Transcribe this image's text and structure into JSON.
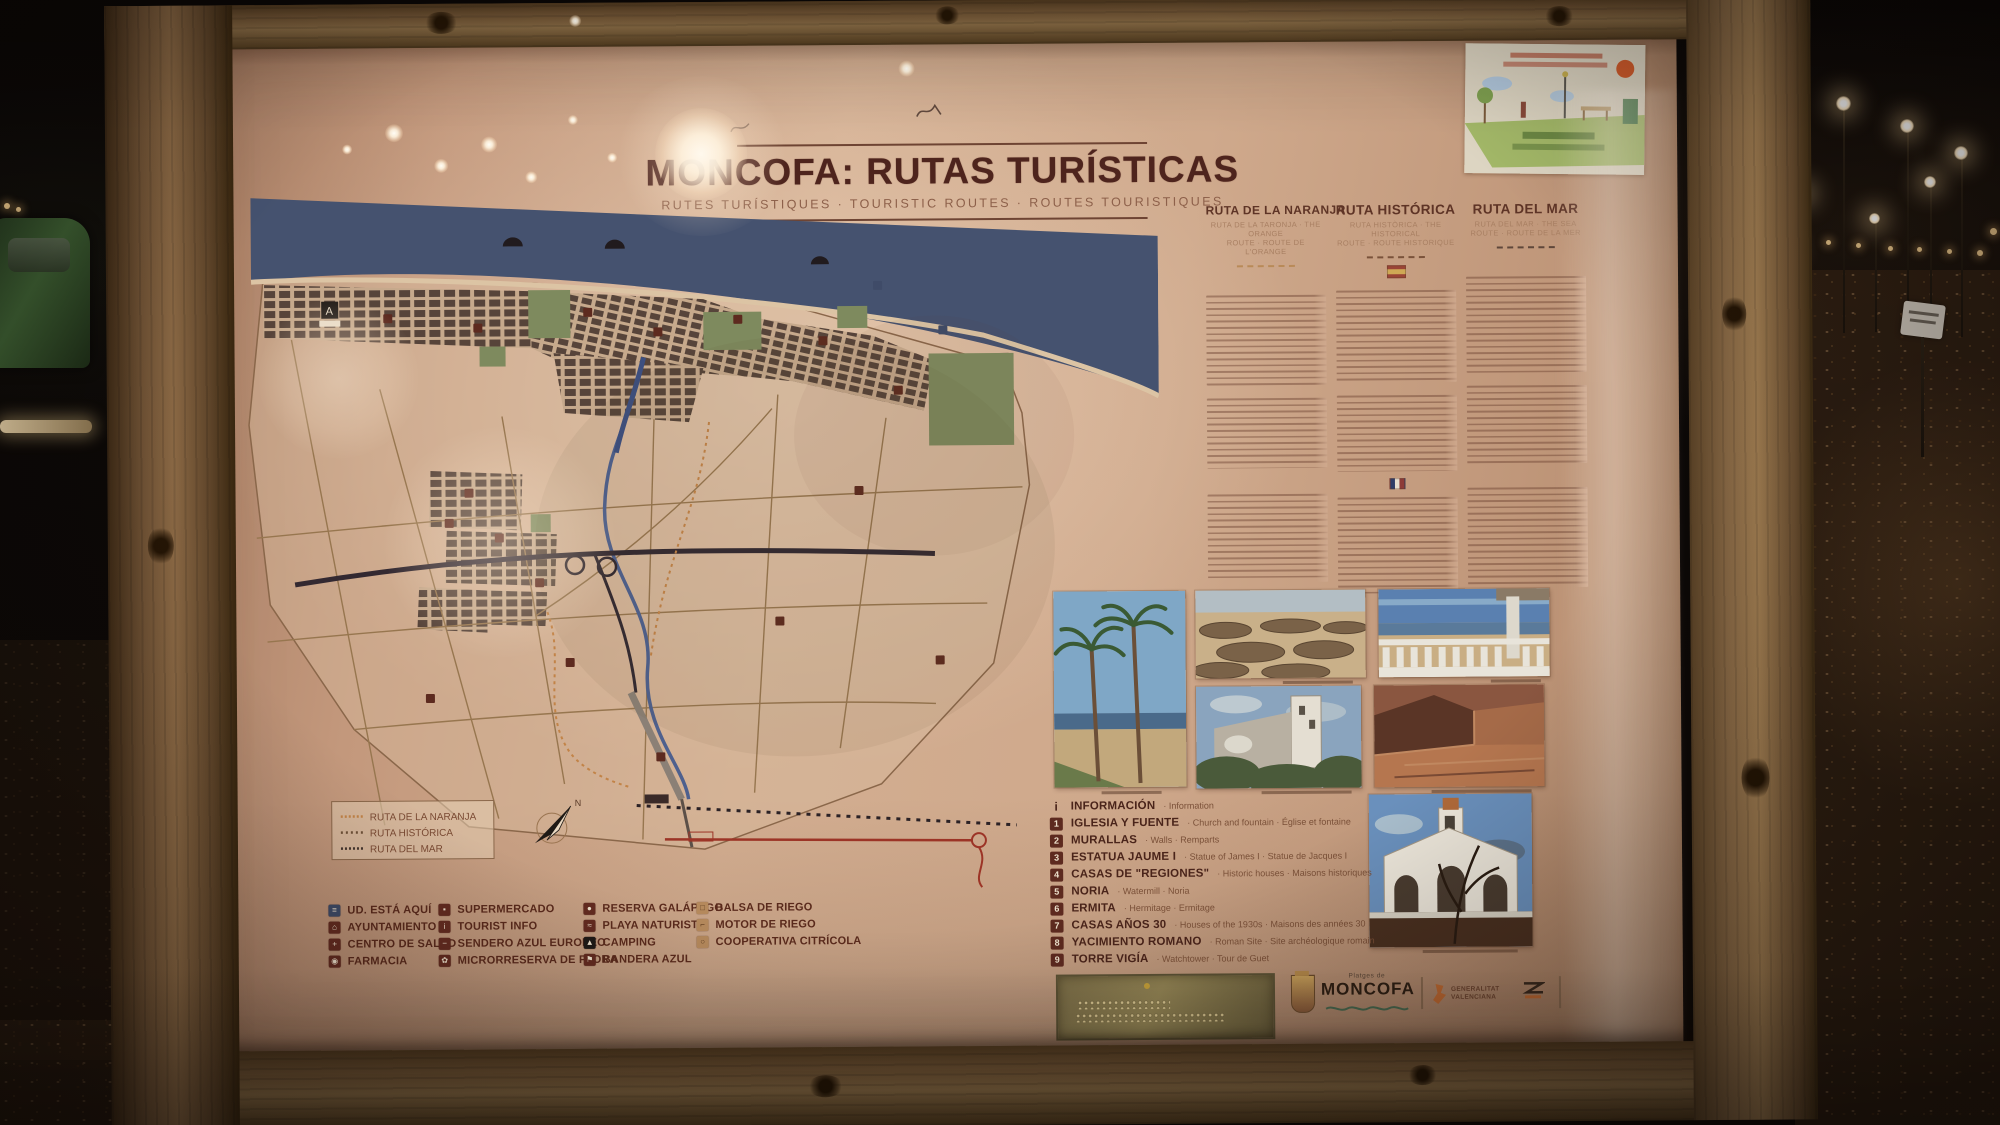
{
  "sign": {
    "title": "MONCOFA: RUTAS TURÍSTICAS",
    "subtitle": "RUTES TURÍSTIQUES · TOURISTIC ROUTES · ROUTES TOURISTIQUES",
    "routes": [
      {
        "name": "RUTA DE LA NARANJA",
        "sub1": "RUTA DE LA TARONJA · THE ORANGE",
        "sub2": "ROUTE · ROUTE DE L'ORANGE"
      },
      {
        "name": "RUTA HISTÓRICA",
        "sub1": "RUTA HISTÒRICA · THE HISTORICAL",
        "sub2": "ROUTE · ROUTE HISTORIQUE"
      },
      {
        "name": "RUTA DEL MAR",
        "sub1": "RUTA DEL MAR · THE SEA",
        "sub2": "ROUTE · ROUTE DE LA MER"
      }
    ],
    "map_legend": [
      "RUTA DE LA NARANJA",
      "RUTA HISTÓRICA",
      "RUTA DEL MAR"
    ],
    "compass_n": "N",
    "legend": {
      "columns": [
        {
          "items": [
            {
              "glyph": "≡",
              "icon": "you-are-here-icon",
              "label": "UD. ESTÁ AQUÍ"
            },
            {
              "glyph": "⌂",
              "icon": "town-hall-icon",
              "label": "AYUNTAMIENTO"
            },
            {
              "glyph": "+",
              "icon": "health-centre-icon",
              "label": "CENTRO DE SALUD"
            },
            {
              "glyph": "◉",
              "icon": "pharmacy-icon",
              "label": "FARMACIA"
            }
          ]
        },
        {
          "items": [
            {
              "glyph": "▪",
              "icon": "supermarket-icon",
              "label": "SUPERMERCADO"
            },
            {
              "glyph": "i",
              "icon": "tourist-info-icon",
              "label": "TOURIST INFO"
            },
            {
              "glyph": "−",
              "icon": "blue-trail-icon",
              "label": "SENDERO AZUL EUROPEO"
            },
            {
              "glyph": "✿",
              "icon": "flora-reserve-icon",
              "label": "MICRORRESERVA DE FLORA"
            }
          ]
        },
        {
          "items": [
            {
              "glyph": "●",
              "icon": "turtle-reserve-icon",
              "label": "RESERVA GALÁPAGO"
            },
            {
              "glyph": "≈",
              "icon": "naturist-beach-icon",
              "label": "PLAYA NATURISTA"
            },
            {
              "glyph": "▲",
              "icon": "camping-icon",
              "label": "CAMPING"
            },
            {
              "glyph": "⚑",
              "icon": "blue-flag-icon",
              "label": "BANDERA AZUL"
            }
          ]
        },
        {
          "items": [
            {
              "glyph": "□",
              "icon": "irrigation-pond-icon",
              "label": "BALSA DE RIEGO"
            },
            {
              "glyph": "⌐",
              "icon": "irrigation-pump-icon",
              "label": "MOTOR DE RIEGO"
            },
            {
              "glyph": "○",
              "icon": "citrus-cooperative-icon",
              "label": "COOPERATIVA CITRÍCOLA"
            }
          ]
        }
      ]
    },
    "poi": [
      {
        "num": "i",
        "name": "INFORMACIÓN",
        "trans": "· Information"
      },
      {
        "num": "1",
        "name": "IGLESIA Y FUENTE",
        "trans": "· Church and fountain · Église et fontaine"
      },
      {
        "num": "2",
        "name": "MURALLAS",
        "trans": "· Walls · Remparts"
      },
      {
        "num": "3",
        "name": "ESTATUA JAUME I",
        "trans": "· Statue of James I · Statue de Jacques I"
      },
      {
        "num": "4",
        "name": "CASAS DE \"REGIONES\"",
        "trans": "· Historic houses · Maisons historiques"
      },
      {
        "num": "5",
        "name": "NORIA",
        "trans": "· Watermill · Noria"
      },
      {
        "num": "6",
        "name": "ERMITA",
        "trans": "· Hermitage · Ermitage"
      },
      {
        "num": "7",
        "name": "CASAS AÑOS 30",
        "trans": "· Houses of the 1930s · Maisons des années 30"
      },
      {
        "num": "8",
        "name": "YACIMIENTO ROMANO",
        "trans": "· Roman Site · Site archéologique romain"
      },
      {
        "num": "9",
        "name": "TORRE VIGÍA",
        "trans": "· Watchtower · Tour de Guet"
      }
    ],
    "logos": {
      "platges": "Platges de",
      "moncofa": "MONCOFA",
      "gva1": "GENERALITAT",
      "gva2": "VALENCIANA"
    },
    "colors": {
      "panel": "#cfa98e",
      "wood": "#6b4d30",
      "sea": "#45526f",
      "maroon": "#632b20",
      "tan": "#b5895c",
      "route_orange": "#c28347",
      "route_red": "#9c3426",
      "title_text": "#4e241d"
    }
  }
}
